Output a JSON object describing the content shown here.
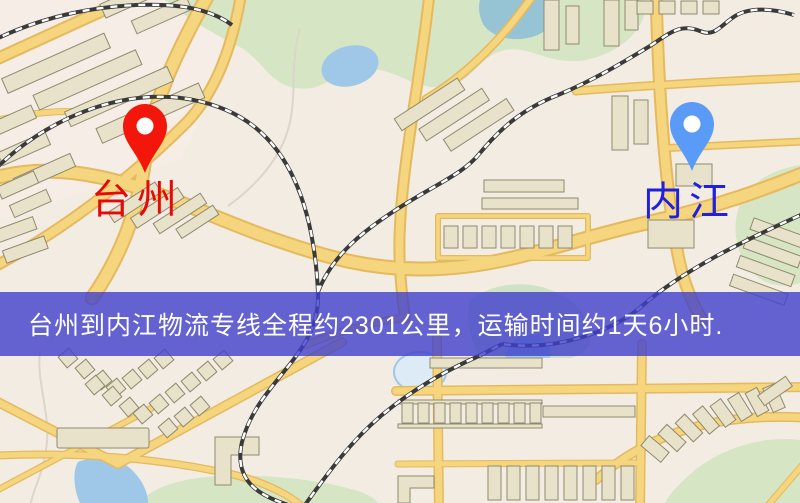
{
  "banner": {
    "text": "台州到内江物流专线全程约2301公里，运输时间约1天6小时.",
    "background_color": "#4040cc",
    "text_color": "#ffffff"
  },
  "origin_marker": {
    "label": "台州",
    "pin_color": "#f3160b",
    "label_color": "#e60909"
  },
  "destination_marker": {
    "label": "内江",
    "pin_color": "#5b9bf8",
    "label_color": "#2121dd"
  },
  "map_palette": {
    "land": "#f2ece3",
    "road": "#f5d57e",
    "road_casing": "#e5b95e",
    "building": "#e9e2ca",
    "building_outline": "#8f8a6e",
    "park": "#d6e5c3",
    "water": "#9fc8e8",
    "railway": "#3a3a3a"
  }
}
